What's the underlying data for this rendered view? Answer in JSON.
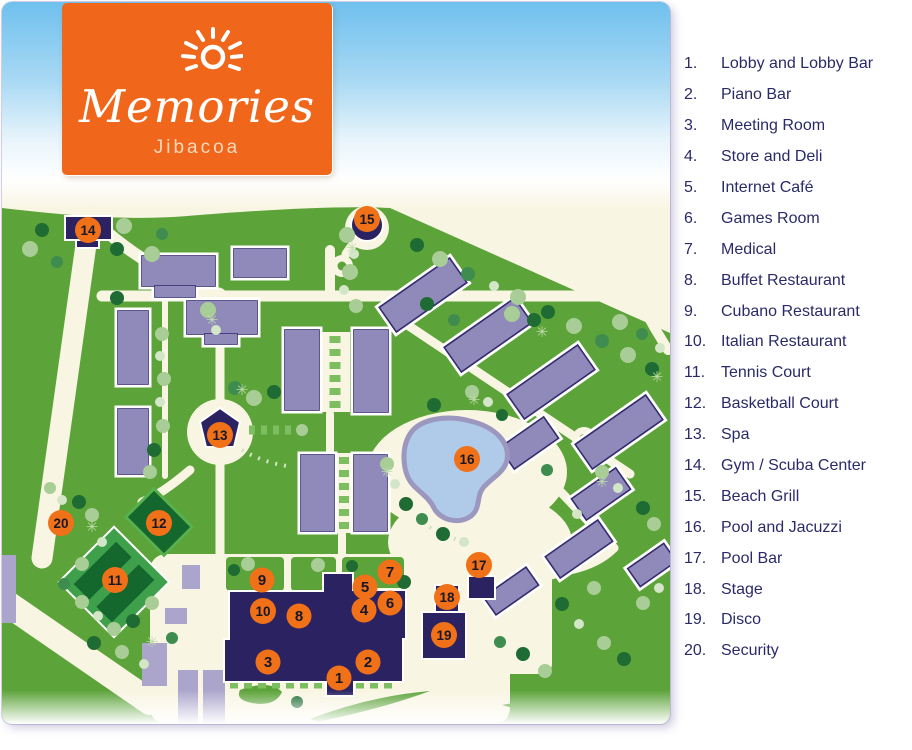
{
  "logo": {
    "brand": "Memories",
    "location": "Jibacoa"
  },
  "legend": {
    "items": [
      {
        "number": "1.",
        "label": "Lobby and Lobby Bar"
      },
      {
        "number": "2.",
        "label": "Piano Bar"
      },
      {
        "number": "3.",
        "label": "Meeting Room"
      },
      {
        "number": "4.",
        "label": "Store and Deli"
      },
      {
        "number": "5.",
        "label": "Internet Café"
      },
      {
        "number": "6.",
        "label": "Games Room"
      },
      {
        "number": "7.",
        "label": "Medical"
      },
      {
        "number": "8.",
        "label": "Buffet Restaurant"
      },
      {
        "number": "9.",
        "label": "Cubano Restaurant"
      },
      {
        "number": "10.",
        "label": "Italian Restaurant"
      },
      {
        "number": "11.",
        "label": "Tennis Court"
      },
      {
        "number": "12.",
        "label": "Basketball Court"
      },
      {
        "number": "13.",
        "label": "Spa"
      },
      {
        "number": "14.",
        "label": "Gym / Scuba Center"
      },
      {
        "number": "15.",
        "label": "Beach Grill"
      },
      {
        "number": "16.",
        "label": "Pool and Jacuzzi"
      },
      {
        "number": "17.",
        "label": "Pool Bar"
      },
      {
        "number": "18.",
        "label": "Stage"
      },
      {
        "number": "19.",
        "label": "Disco"
      },
      {
        "number": "20.",
        "label": "Security"
      }
    ]
  },
  "markers": [
    {
      "n": "1",
      "x": 337,
      "y": 676
    },
    {
      "n": "2",
      "x": 366,
      "y": 660
    },
    {
      "n": "3",
      "x": 266,
      "y": 660
    },
    {
      "n": "4",
      "x": 362,
      "y": 608
    },
    {
      "n": "5",
      "x": 363,
      "y": 585
    },
    {
      "n": "6",
      "x": 388,
      "y": 601
    },
    {
      "n": "7",
      "x": 388,
      "y": 570
    },
    {
      "n": "8",
      "x": 297,
      "y": 614
    },
    {
      "n": "9",
      "x": 260,
      "y": 578
    },
    {
      "n": "10",
      "x": 261,
      "y": 609
    },
    {
      "n": "11",
      "x": 113,
      "y": 578
    },
    {
      "n": "12",
      "x": 157,
      "y": 521
    },
    {
      "n": "13",
      "x": 218,
      "y": 433
    },
    {
      "n": "14",
      "x": 86,
      "y": 228
    },
    {
      "n": "15",
      "x": 365,
      "y": 217
    },
    {
      "n": "16",
      "x": 465,
      "y": 457
    },
    {
      "n": "17",
      "x": 477,
      "y": 563
    },
    {
      "n": "18",
      "x": 445,
      "y": 595
    },
    {
      "n": "19",
      "x": 442,
      "y": 633
    },
    {
      "n": "20",
      "x": 59,
      "y": 521
    }
  ],
  "colors": {
    "orange": "#F07118",
    "logo_orange": "#F0671C",
    "navy": "#2B2262",
    "text_navy": "#2B2A68",
    "grass": "#5CA339",
    "cream": "#F8F5E2",
    "bld": "#8F8ABA",
    "bld_light": "#ABA5CB",
    "pool": "#AFCBE9",
    "pool_edge": "#9B97BE",
    "court_outer": "#3FA04C",
    "court_dark": "#15682D",
    "hedge": "#7CBE60",
    "sky": "#6FC0EE"
  }
}
